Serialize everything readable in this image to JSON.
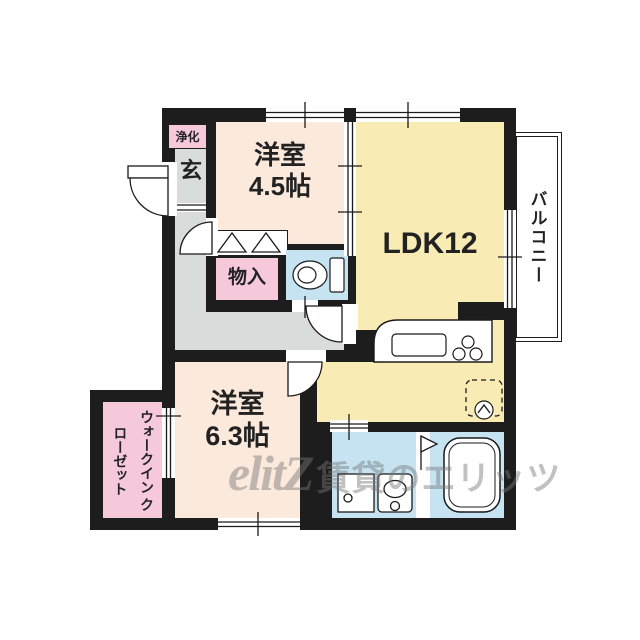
{
  "watermark": {
    "logo": "elitZ",
    "text": "賃貸のエリッツ"
  },
  "labels": {
    "septic": "浄化",
    "entrance": "玄",
    "room1_name": "洋室",
    "room1_size": "4.5帖",
    "ldk": "LDK12",
    "storage": "物入",
    "room2_name": "洋室",
    "room2_size": "6.3帖",
    "wic_line1": "ウォークイン",
    "wic_line2": "クローゼット",
    "balcony": "バルコニー"
  },
  "colors": {
    "wall": "#1d1d1d",
    "room-cream": "#fbe9db",
    "ldk-yellow": "#f8ecb4",
    "pink": "#f6c9da",
    "water-blue": "#c6e3f2",
    "hall-gray": "#d8dcda",
    "text": "#222222",
    "watermark": "#787878"
  }
}
